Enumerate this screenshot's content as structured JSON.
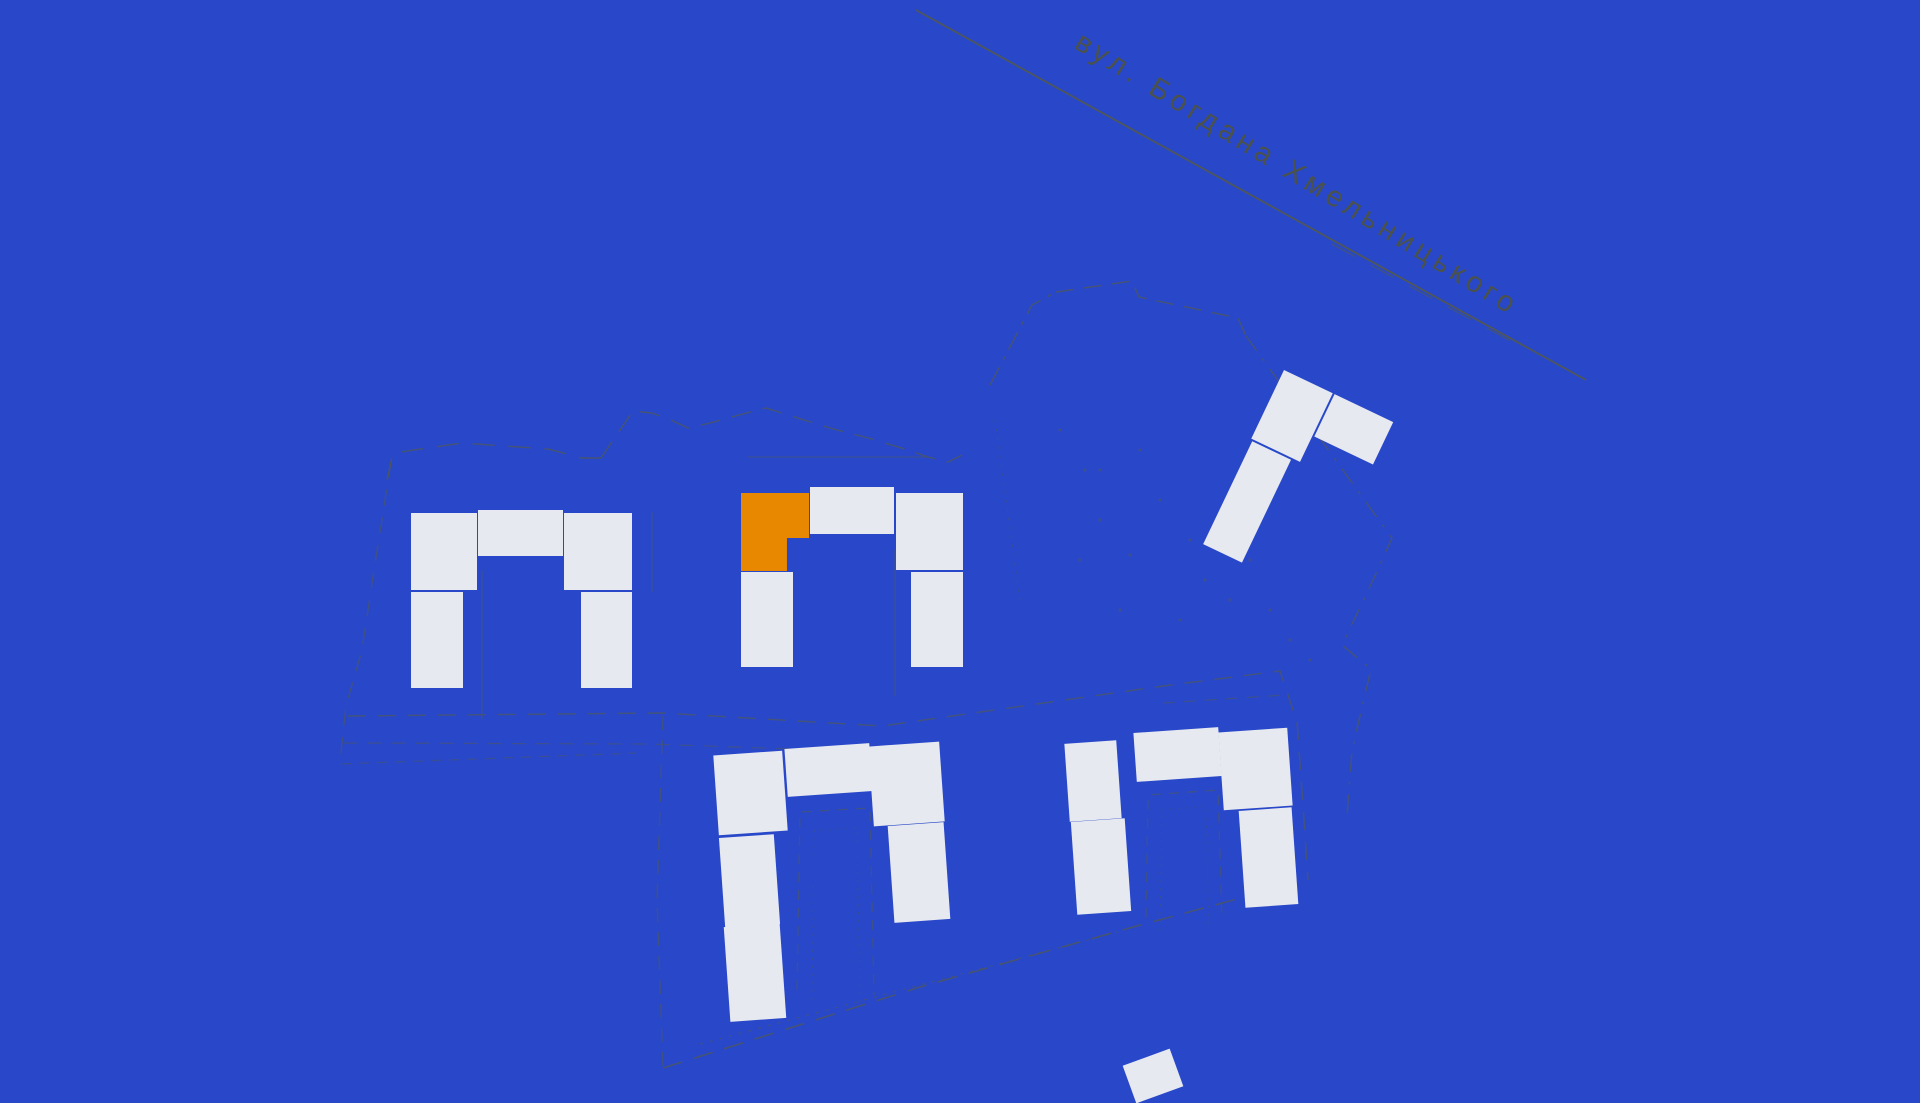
{
  "street": {
    "label": "вул. Богдана Хмельницького"
  },
  "colors": {
    "background": "#2948c9",
    "building": "#e6e9ef",
    "highlight": "#e88700",
    "line": "#565b44",
    "label": "#4e5340"
  },
  "buildings": [
    {
      "id": "building-left",
      "shape": "U",
      "blocks": 5,
      "highlighted": false
    },
    {
      "id": "building-middle",
      "shape": "U",
      "blocks": 5,
      "highlighted": true
    },
    {
      "id": "building-right",
      "shape": "L",
      "blocks": 3,
      "highlighted": false
    },
    {
      "id": "building-bottom-middle",
      "shape": "U",
      "blocks": 6,
      "highlighted": false
    },
    {
      "id": "building-bottom-right",
      "shape": "U",
      "blocks": 5,
      "highlighted": false
    }
  ]
}
